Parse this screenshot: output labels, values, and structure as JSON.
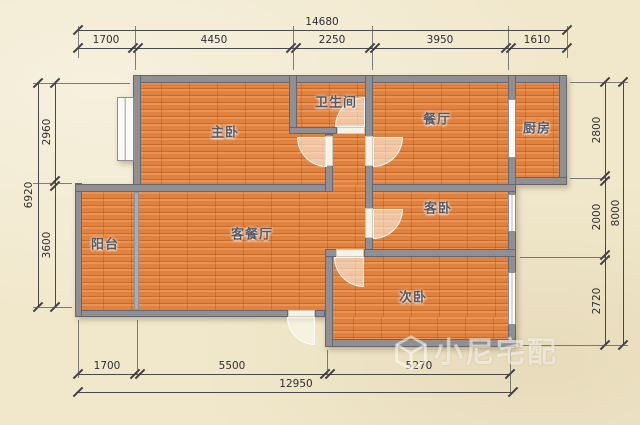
{
  "rooms": [
    {
      "id": "master-bedroom",
      "label": "主卧"
    },
    {
      "id": "bathroom",
      "label": "卫生间"
    },
    {
      "id": "dining-room",
      "label": "餐厅"
    },
    {
      "id": "kitchen",
      "label": "厨房"
    },
    {
      "id": "guest-bedroom",
      "label": "客卧"
    },
    {
      "id": "living-dining",
      "label": "客餐厅"
    },
    {
      "id": "balcony",
      "label": "阳台"
    },
    {
      "id": "second-bedroom",
      "label": "次卧"
    }
  ],
  "dimensions": {
    "top": {
      "total": "14680",
      "segments": [
        "1700",
        "4450",
        "2250",
        "3950",
        "1610"
      ]
    },
    "bottom": {
      "total": "12950",
      "segments": [
        "1700",
        "5500",
        "5270"
      ]
    },
    "left": {
      "total": "6920",
      "segments": [
        "2960",
        "3600"
      ]
    },
    "right": {
      "total": "8000",
      "segments": [
        "2800",
        "2000",
        "2720"
      ]
    }
  },
  "watermark": {
    "brand": "小尼宅配"
  },
  "colors": {
    "background": "#f1e8cc",
    "wall": "#8f8f94",
    "floor": "#df823f",
    "dimension_line": "#48484c",
    "room_label": "#555a66",
    "watermark": "rgba(255,255,255,0.55)"
  }
}
